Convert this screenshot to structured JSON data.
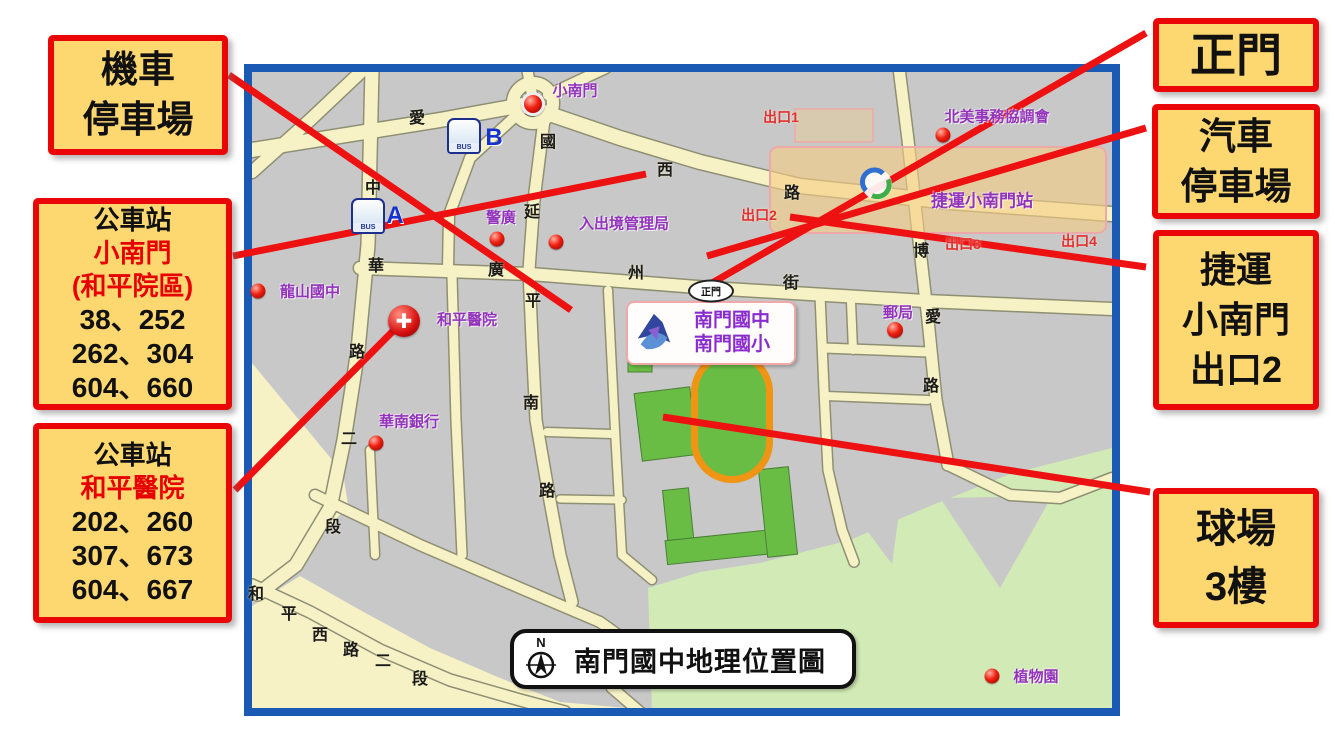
{
  "callouts": {
    "moto_parking": {
      "lines": [
        "機車",
        "停車場"
      ]
    },
    "bus_xiaonanmen": {
      "title": "公車站",
      "name": "小南門",
      "name2": "(和平院區)",
      "routes": [
        "38、252",
        "262、304",
        "604、660"
      ]
    },
    "bus_heping": {
      "title": "公車站",
      "name": "和平醫院",
      "routes": [
        "202、260",
        "307、673",
        "604、667"
      ]
    },
    "main_gate": {
      "lines": [
        "正門"
      ]
    },
    "car_parking": {
      "lines": [
        "汽車",
        "停車場"
      ]
    },
    "mrt_exit2": {
      "lines": [
        "捷運",
        "小南門",
        "出口2"
      ]
    },
    "court_3f": {
      "lines": [
        "球場",
        "3樓"
      ]
    }
  },
  "map": {
    "title": "南門國中地理位置圖",
    "compass_label": "N",
    "school_label": {
      "line1": "南門國中",
      "line2": "南門國小"
    },
    "gate_badge": "正門",
    "station_label": "捷運小南門站",
    "bus_icon_text": "BUS"
  },
  "map_labels": {
    "street_chars": [
      {
        "t": "愛",
        "x": 417,
        "y": 116
      },
      {
        "t": "國",
        "x": 548,
        "y": 140
      },
      {
        "t": "西",
        "x": 665,
        "y": 168
      },
      {
        "t": "路",
        "x": 792,
        "y": 191
      },
      {
        "t": "中",
        "x": 373,
        "y": 186
      },
      {
        "t": "華",
        "x": 376,
        "y": 264
      },
      {
        "t": "路",
        "x": 357,
        "y": 350
      },
      {
        "t": "二",
        "x": 349,
        "y": 437
      },
      {
        "t": "段",
        "x": 333,
        "y": 525
      },
      {
        "t": "延",
        "x": 532,
        "y": 210
      },
      {
        "t": "平",
        "x": 533,
        "y": 299
      },
      {
        "t": "南",
        "x": 531,
        "y": 401
      },
      {
        "t": "路",
        "x": 547,
        "y": 489
      },
      {
        "t": "廣",
        "x": 496,
        "y": 268
      },
      {
        "t": "州",
        "x": 636,
        "y": 271
      },
      {
        "t": "街",
        "x": 791,
        "y": 281
      },
      {
        "t": "博",
        "x": 921,
        "y": 249
      },
      {
        "t": "愛",
        "x": 933,
        "y": 315
      },
      {
        "t": "路",
        "x": 931,
        "y": 384
      },
      {
        "t": "和",
        "x": 256,
        "y": 592
      },
      {
        "t": "平",
        "x": 289,
        "y": 612
      },
      {
        "t": "西",
        "x": 320,
        "y": 633
      },
      {
        "t": "路",
        "x": 351,
        "y": 648
      },
      {
        "t": "二",
        "x": 383,
        "y": 659
      },
      {
        "t": "段",
        "x": 420,
        "y": 677
      }
    ],
    "pois": [
      {
        "t": "小南門",
        "x": 575,
        "y": 90
      },
      {
        "t": "警廣",
        "x": 501,
        "y": 217
      },
      {
        "t": "入出境管理局",
        "x": 624,
        "y": 223
      },
      {
        "t": "龍山國中",
        "x": 310,
        "y": 291
      },
      {
        "t": "和平醫院",
        "x": 467,
        "y": 319
      },
      {
        "t": "華南銀行",
        "x": 409,
        "y": 421
      },
      {
        "t": "郵局",
        "x": 898,
        "y": 312
      },
      {
        "t": "北美事務協調會",
        "x": 997,
        "y": 116
      },
      {
        "t": "捷運小南門站",
        "x": 982,
        "y": 199,
        "big": true
      },
      {
        "t": "植物園",
        "x": 1036,
        "y": 676
      }
    ],
    "exits": [
      {
        "t": "出口1",
        "x": 781,
        "y": 117
      },
      {
        "t": "出口2",
        "x": 759,
        "y": 215
      },
      {
        "t": "出口3",
        "x": 963,
        "y": 244
      },
      {
        "t": "出口4",
        "x": 1079,
        "y": 241
      }
    ],
    "dots": [
      {
        "x": 533,
        "y": 104,
        "r": 18,
        "ring": true
      },
      {
        "x": 497,
        "y": 239,
        "r": 15
      },
      {
        "x": 556,
        "y": 242,
        "r": 15
      },
      {
        "x": 258,
        "y": 291,
        "r": 15
      },
      {
        "x": 376,
        "y": 443,
        "r": 15
      },
      {
        "x": 895,
        "y": 330,
        "r": 16
      },
      {
        "x": 943,
        "y": 135,
        "r": 15
      },
      {
        "x": 992,
        "y": 676,
        "r": 15
      }
    ],
    "bus_stops": [
      {
        "letter": "A",
        "ix": 368,
        "iy": 216,
        "lx": 395,
        "ly": 216
      },
      {
        "letter": "B",
        "ix": 464,
        "iy": 136,
        "lx": 494,
        "ly": 138
      }
    ],
    "hospital_cross": {
      "x": 404,
      "y": 321
    },
    "gate_badge_pos": {
      "x": 711,
      "y": 291
    },
    "mrt_logo_pos": {
      "x": 877,
      "y": 187
    }
  },
  "map_geometry": {
    "frame": {
      "x": 244,
      "y": 64,
      "w": 876,
      "h": 652,
      "border": 8
    },
    "cream_areas": [
      [
        [
          252,
          363
        ],
        [
          343,
          473
        ],
        [
          348,
          505
        ],
        [
          300,
          562
        ],
        [
          258,
          592
        ],
        [
          252,
          598
        ]
      ],
      [
        [
          252,
          606
        ],
        [
          300,
          576
        ],
        [
          360,
          610
        ],
        [
          430,
          648
        ],
        [
          500,
          678
        ],
        [
          560,
          702
        ],
        [
          648,
          710
        ],
        [
          648,
          712
        ],
        [
          252,
          712
        ]
      ]
    ],
    "garden": [
      [
        652,
        712
      ],
      [
        648,
        588
      ],
      [
        700,
        572
      ],
      [
        760,
        563
      ],
      [
        850,
        540
      ],
      [
        930,
        506
      ],
      [
        1010,
        474
      ],
      [
        1112,
        448
      ],
      [
        1112,
        712
      ]
    ],
    "garden_wedges": [
      [
        [
          940,
          498
        ],
        [
          1052,
          496
        ],
        [
          1000,
          588
        ]
      ],
      [
        [
          856,
          516
        ],
        [
          900,
          506
        ],
        [
          892,
          564
        ]
      ]
    ],
    "roads": [
      {
        "pts": [
          [
            252,
            150
          ],
          [
            440,
            120
          ],
          [
            523,
            105
          ],
          [
            620,
            138
          ],
          [
            700,
            162
          ],
          [
            800,
            186
          ],
          [
            950,
            202
          ],
          [
            1112,
            214
          ]
        ],
        "w": 14
      },
      {
        "pts": [
          [
            252,
            172
          ],
          [
            310,
            120
          ],
          [
            365,
            68
          ]
        ],
        "w": 12
      },
      {
        "pts": [
          [
            533,
            100
          ],
          [
            527,
            68
          ]
        ],
        "w": 10
      },
      {
        "pts": [
          [
            548,
            95
          ],
          [
            606,
            68
          ]
        ],
        "w": 10
      },
      {
        "pts": [
          [
            372,
            68
          ],
          [
            368,
            245
          ],
          [
            358,
            350
          ],
          [
            344,
            440
          ],
          [
            330,
            508
          ],
          [
            296,
            565
          ],
          [
            258,
            594
          ]
        ],
        "w": 13
      },
      {
        "pts": [
          [
            520,
            112
          ],
          [
            470,
            158
          ],
          [
            449,
            215
          ],
          [
            448,
            268
          ]
        ],
        "w": 10
      },
      {
        "pts": [
          [
            545,
            112
          ],
          [
            534,
            200
          ],
          [
            529,
            270
          ],
          [
            532,
            340
          ],
          [
            536,
            420
          ],
          [
            548,
            490
          ],
          [
            560,
            555
          ],
          [
            572,
            602
          ]
        ],
        "w": 11
      },
      {
        "pts": [
          [
            360,
            268
          ],
          [
            530,
            274
          ],
          [
            710,
            288
          ],
          [
            925,
            301
          ],
          [
            1112,
            309
          ]
        ],
        "w": 12
      },
      {
        "pts": [
          [
            899,
            68
          ],
          [
            908,
            140
          ],
          [
            918,
            232
          ],
          [
            928,
            320
          ],
          [
            936,
            400
          ],
          [
            948,
            465
          ]
        ],
        "w": 11
      },
      {
        "pts": [
          [
            948,
            465
          ],
          [
            1010,
            495
          ],
          [
            1060,
            498
          ],
          [
            1112,
            478
          ]
        ],
        "w": 10
      },
      {
        "pts": [
          [
            608,
            290
          ],
          [
            615,
            430
          ],
          [
            622,
            555
          ]
        ],
        "w": 8
      },
      {
        "pts": [
          [
            547,
            432
          ],
          [
            612,
            434
          ]
        ],
        "w": 8
      },
      {
        "pts": [
          [
            560,
            499
          ],
          [
            622,
            500
          ]
        ],
        "w": 7
      },
      {
        "pts": [
          [
            820,
            295
          ],
          [
            824,
            390
          ],
          [
            828,
            470
          ],
          [
            842,
            530
          ],
          [
            854,
            562
          ]
        ],
        "w": 9
      },
      {
        "pts": [
          [
            824,
            348
          ],
          [
            928,
            352
          ]
        ],
        "w": 9
      },
      {
        "pts": [
          [
            826,
            396
          ],
          [
            928,
            400
          ]
        ],
        "w": 8
      },
      {
        "pts": [
          [
            851,
            302
          ],
          [
            853,
            350
          ]
        ],
        "w": 8
      },
      {
        "pts": [
          [
            315,
            495
          ],
          [
            420,
            545
          ],
          [
            520,
            588
          ],
          [
            600,
            622
          ],
          [
            628,
            642
          ],
          [
            612,
            688
          ],
          [
            640,
            712
          ]
        ],
        "w": 10
      },
      {
        "pts": [
          [
            252,
            585
          ],
          [
            310,
            612
          ],
          [
            380,
            650
          ],
          [
            450,
            680
          ],
          [
            520,
            700
          ],
          [
            565,
            712
          ]
        ],
        "w": 11
      },
      {
        "pts": [
          [
            452,
            276
          ],
          [
            456,
            420
          ],
          [
            462,
            555
          ]
        ],
        "w": 9
      },
      {
        "pts": [
          [
            370,
            450
          ],
          [
            375,
            555
          ]
        ],
        "w": 8
      },
      {
        "pts": [
          [
            622,
            555
          ],
          [
            652,
            580
          ]
        ],
        "w": 8
      }
    ],
    "roundabout": {
      "cx": 533,
      "cy": 103,
      "r": 20
    },
    "field": {
      "track_outer": [
        691,
        351,
        82,
        132,
        41
      ],
      "track_inner": [
        698,
        358,
        68,
        118,
        34
      ],
      "green_rects": [
        {
          "r": [
            638,
            390,
            56,
            68
          ],
          "rot": "-7 666 424"
        },
        {
          "r": [
            666,
            489,
            26,
            68
          ],
          "rot": "-6 679 523"
        },
        {
          "r": [
            666,
            534,
            128,
            24
          ],
          "rot": "-6 730 546"
        },
        {
          "r": [
            763,
            468,
            30,
            88
          ],
          "rot": "-6 778 512"
        },
        {
          "r": [
            628,
            356,
            24,
            16
          ],
          "rot": "0 0 0"
        }
      ]
    },
    "station_band": {
      "x": 770,
      "y": 147,
      "w": 336,
      "h": 86
    },
    "exit1_box": {
      "x": 795,
      "y": 109,
      "w": 78,
      "h": 33
    },
    "red_lines": [
      [
        229,
        75,
        571,
        310
      ],
      [
        233,
        256,
        646,
        174
      ],
      [
        235,
        490,
        402,
        322
      ],
      [
        1146,
        33,
        712,
        283
      ],
      [
        1146,
        128,
        707,
        256
      ],
      [
        1146,
        267,
        790,
        217
      ],
      [
        1150,
        492,
        663,
        417
      ]
    ]
  },
  "colors": {
    "callout_bg": "#fdd76f",
    "callout_border": "#ea0606",
    "red_text": "#e80000",
    "map_border": "#1a5ab5",
    "road": "#f6f2c6",
    "road_edge": "#8f8f74",
    "block": "#c8c8c8",
    "field_green": "#69bd45",
    "track_orange": "#ef9413",
    "garden_green": "#d2eab6",
    "purple": "#9333bb",
    "red_line": "#ee1111",
    "station_band": "rgba(246,205,130,0.62)",
    "station_edge": "#eda9a9"
  }
}
